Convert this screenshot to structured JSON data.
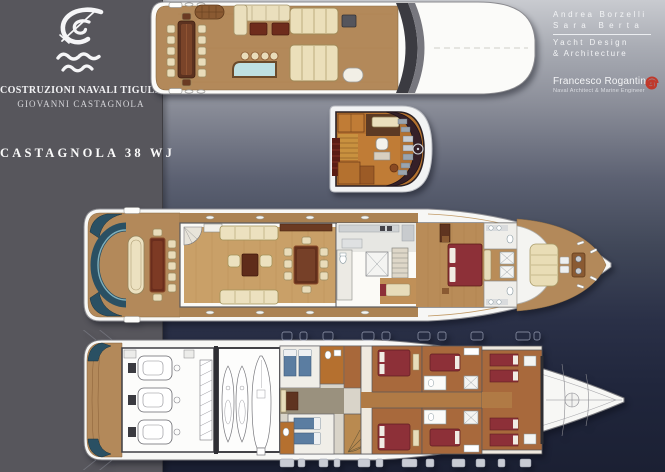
{
  "branding": {
    "company_line1": "COSTRUZIONI NAVALI TIGULLIO",
    "company_line2": "GIOVANNI CASTAGNOLA",
    "model_name": "CASTAGNOLA 38 WJ"
  },
  "credits": {
    "designer1": "Andrea Borzelli",
    "designer2": "Sara Berta",
    "studio_line1": "Yacht Design",
    "studio_line2": "& Architecture",
    "engineer_name": "Francesco Rogantin",
    "engineer_title": "Naval Architect & Marine Engineer"
  },
  "colors": {
    "panel_gray": "#57565c",
    "background_top": "#c9cbd0",
    "background_bottom": "#1b2033",
    "teak": "#b3895a",
    "dark_wood": "#6b3320",
    "table_wood": "#63301c",
    "burgundy": "#8d3038",
    "cream": "#ece1c0",
    "teal": "#2a5063",
    "hull_white": "#f7f7f5",
    "blue_mattress": "#5b7da1",
    "orange_floor": "#b5702f",
    "wheelhouse_floor": "#b4712f",
    "console_dark": "#352028",
    "logo_red": "#c0392b"
  }
}
